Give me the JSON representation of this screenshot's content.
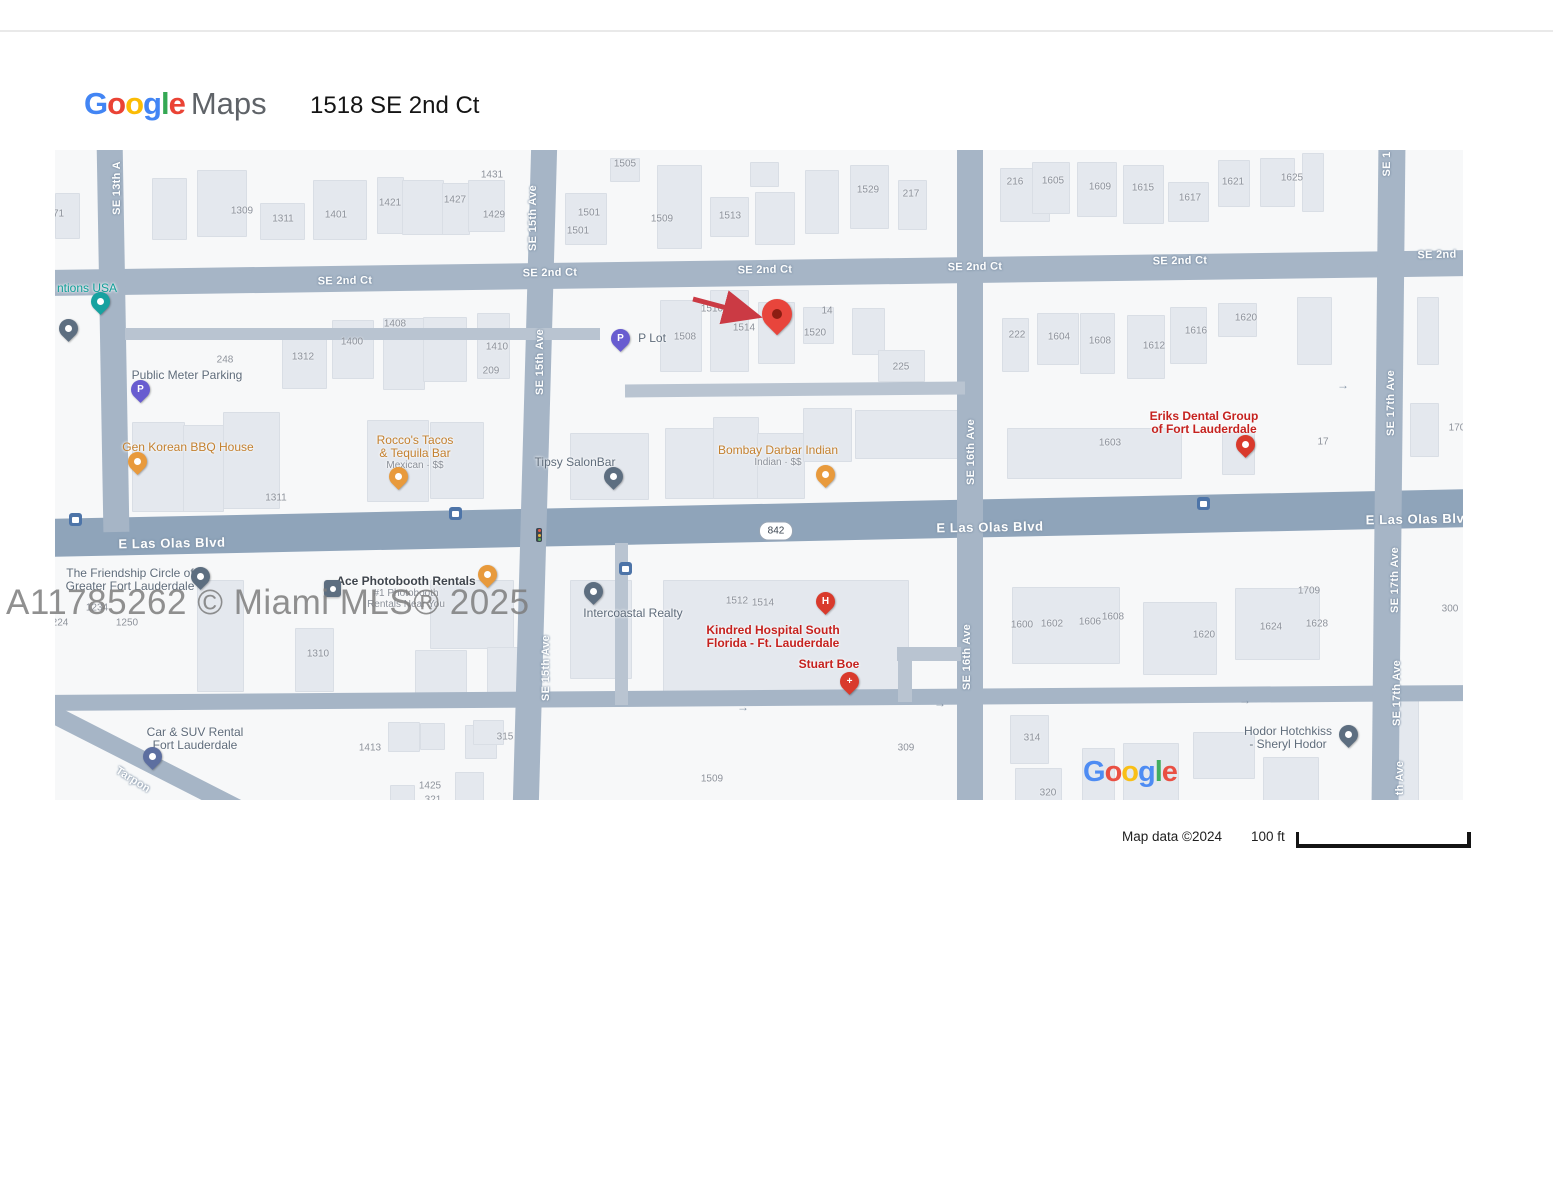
{
  "header": {
    "logo_google": "Google",
    "logo_maps": "Maps",
    "google_colors": [
      "#4285F4",
      "#EA4335",
      "#FBBC05",
      "#4285F4",
      "#34A853",
      "#EA4335"
    ],
    "title": "1518 SE 2nd Ct"
  },
  "watermark": "A11785262 © Miami MLS® 2025",
  "attribution": {
    "map_data": "Map data ©2024",
    "scale_label": "100 ft"
  },
  "map": {
    "google_logo": "Google",
    "colors": {
      "ave": "#a6b5c6",
      "major": "#8fa4ba",
      "minor": "#b9c4d1",
      "teal": "#17a2a0",
      "slate": "#5d6e80",
      "purple": "#685cd0",
      "orange": "#e89a3c",
      "red": "#d93a2c",
      "carblue": "#5d6fa0",
      "dest": "#e8453c",
      "pteal": "#0f9e98",
      "pgray": "#5f6c7b",
      "porange": "#c3802f",
      "pred": "#c5221f",
      "pdark": "#3f454d"
    },
    "roads": [
      {
        "x": -10,
        "y": 110,
        "w": 1430,
        "h": 26,
        "rot": -0.8,
        "c": "ave"
      },
      {
        "x": -10,
        "y": 354,
        "w": 1430,
        "h": 38,
        "rot": -1.2,
        "c": "major"
      },
      {
        "x": -10,
        "y": 540,
        "w": 1430,
        "h": 16,
        "rot": -0.4,
        "c": "ave"
      },
      {
        "x": 45,
        "y": -8,
        "w": 26,
        "h": 390,
        "rot": -1,
        "c": "ave"
      },
      {
        "x": 467,
        "y": -8,
        "w": 26,
        "h": 666,
        "rot": 1.6,
        "c": "ave"
      },
      {
        "x": 902,
        "y": -8,
        "w": 26,
        "h": 666,
        "rot": 0,
        "c": "ave"
      },
      {
        "x": 1320,
        "y": -8,
        "w": 27,
        "h": 666,
        "rot": 0.6,
        "c": "ave"
      },
      {
        "x": 70,
        "y": 178,
        "w": 475,
        "h": 12,
        "rot": 0,
        "c": "minor"
      },
      {
        "x": 570,
        "y": 233,
        "w": 340,
        "h": 13,
        "rot": -0.5,
        "c": "minor"
      },
      {
        "x": 560,
        "y": 393,
        "w": 13,
        "h": 162,
        "rot": 0,
        "c": "minor"
      },
      {
        "x": 842,
        "y": 497,
        "w": 64,
        "h": 14,
        "rot": 0,
        "c": "minor"
      },
      {
        "x": 843,
        "y": 497,
        "w": 14,
        "h": 55,
        "rot": 0,
        "c": "minor"
      },
      {
        "x": -45,
        "y": 597,
        "w": 250,
        "h": 18,
        "rot": 27,
        "c": "ave"
      }
    ],
    "buildings": [
      [
        0,
        43,
        23,
        44
      ],
      [
        97,
        28,
        33,
        60
      ],
      [
        142,
        20,
        48,
        65
      ],
      [
        205,
        53,
        43,
        35
      ],
      [
        258,
        30,
        52,
        58
      ],
      [
        322,
        27,
        25,
        55
      ],
      [
        347,
        30,
        40,
        53
      ],
      [
        387,
        33,
        26,
        50
      ],
      [
        413,
        30,
        35,
        50
      ],
      [
        510,
        43,
        40,
        50
      ],
      [
        555,
        8,
        28,
        22
      ],
      [
        602,
        15,
        43,
        82
      ],
      [
        655,
        47,
        37,
        38
      ],
      [
        695,
        12,
        27,
        23
      ],
      [
        700,
        42,
        38,
        51
      ],
      [
        750,
        20,
        32,
        62
      ],
      [
        795,
        15,
        37,
        62
      ],
      [
        843,
        30,
        27,
        48
      ],
      [
        945,
        18,
        48,
        52
      ],
      [
        977,
        12,
        36,
        50
      ],
      [
        1022,
        12,
        38,
        53
      ],
      [
        1068,
        15,
        39,
        57
      ],
      [
        1113,
        32,
        39,
        38
      ],
      [
        1163,
        10,
        30,
        45
      ],
      [
        1205,
        8,
        33,
        47
      ],
      [
        1247,
        3,
        20,
        57
      ],
      [
        227,
        182,
        43,
        55
      ],
      [
        277,
        170,
        40,
        57
      ],
      [
        328,
        168,
        40,
        70
      ],
      [
        368,
        167,
        42,
        63
      ],
      [
        422,
        163,
        31,
        64
      ],
      [
        605,
        150,
        40,
        70
      ],
      [
        655,
        140,
        37,
        80
      ],
      [
        703,
        152,
        35,
        60
      ],
      [
        748,
        157,
        29,
        35
      ],
      [
        797,
        158,
        31,
        45
      ],
      [
        823,
        200,
        45,
        30
      ],
      [
        947,
        168,
        25,
        52
      ],
      [
        982,
        163,
        40,
        50
      ],
      [
        1025,
        163,
        33,
        59
      ],
      [
        1072,
        165,
        36,
        62
      ],
      [
        1115,
        157,
        35,
        55
      ],
      [
        1163,
        153,
        37,
        32
      ],
      [
        1242,
        147,
        33,
        66
      ],
      [
        1362,
        147,
        20,
        66
      ],
      [
        952,
        278,
        173,
        49
      ],
      [
        1167,
        282,
        31,
        41
      ],
      [
        1355,
        253,
        27,
        52
      ],
      [
        77,
        272,
        51,
        88
      ],
      [
        128,
        275,
        39,
        85
      ],
      [
        168,
        262,
        55,
        95
      ],
      [
        312,
        270,
        60,
        80
      ],
      [
        375,
        272,
        52,
        75
      ],
      [
        515,
        283,
        77,
        65
      ],
      [
        610,
        278,
        47,
        69
      ],
      [
        658,
        267,
        44,
        80
      ],
      [
        702,
        283,
        46,
        64
      ],
      [
        748,
        258,
        47,
        52
      ],
      [
        800,
        260,
        105,
        47
      ],
      [
        142,
        430,
        45,
        110
      ],
      [
        240,
        478,
        37,
        62
      ],
      [
        375,
        430,
        82,
        67
      ],
      [
        360,
        500,
        50,
        50
      ],
      [
        432,
        497,
        41,
        50
      ],
      [
        515,
        430,
        60,
        97
      ],
      [
        608,
        430,
        244,
        117
      ],
      [
        957,
        437,
        106,
        75
      ],
      [
        1088,
        452,
        72,
        71
      ],
      [
        1180,
        438,
        83,
        70
      ],
      [
        955,
        565,
        37,
        47
      ],
      [
        960,
        618,
        45,
        32
      ],
      [
        1027,
        598,
        31,
        52
      ],
      [
        1068,
        593,
        54,
        57
      ],
      [
        1138,
        582,
        60,
        45
      ],
      [
        1208,
        607,
        54,
        43
      ],
      [
        1338,
        538,
        24,
        112
      ],
      [
        333,
        572,
        30,
        28
      ],
      [
        365,
        573,
        23,
        25
      ],
      [
        410,
        575,
        30,
        32
      ],
      [
        400,
        622,
        27,
        28
      ],
      [
        335,
        635,
        23,
        15
      ],
      [
        418,
        570,
        29,
        23
      ]
    ],
    "numbers": [
      [
        "1271",
        -2,
        64
      ],
      [
        "1309",
        187,
        61
      ],
      [
        "1311",
        228,
        69
      ],
      [
        "1401",
        281,
        65
      ],
      [
        "1421",
        335,
        53
      ],
      [
        "1427",
        400,
        50
      ],
      [
        "1429",
        439,
        65
      ],
      [
        "1431",
        437,
        25
      ],
      [
        "1505",
        570,
        14
      ],
      [
        "1501",
        534,
        63
      ],
      [
        "1501",
        523,
        81
      ],
      [
        "1509",
        607,
        69
      ],
      [
        "1513",
        675,
        66
      ],
      [
        "1529",
        813,
        40
      ],
      [
        "217",
        856,
        44
      ],
      [
        "216",
        960,
        32
      ],
      [
        "1605",
        998,
        31
      ],
      [
        "1609",
        1045,
        37
      ],
      [
        "1615",
        1088,
        38
      ],
      [
        "1617",
        1135,
        48
      ],
      [
        "1621",
        1178,
        32
      ],
      [
        "1625",
        1237,
        28
      ],
      [
        "1408",
        340,
        174
      ],
      [
        "1400",
        297,
        192
      ],
      [
        "1312",
        248,
        207
      ],
      [
        "248",
        170,
        210
      ],
      [
        "1410",
        442,
        197
      ],
      [
        "209",
        436,
        221
      ],
      [
        "1510",
        657,
        159
      ],
      [
        "1514",
        689,
        178
      ],
      [
        "1508",
        630,
        187
      ],
      [
        "14",
        772,
        161
      ],
      [
        "1520",
        760,
        183
      ],
      [
        "225",
        846,
        217
      ],
      [
        "222",
        962,
        185
      ],
      [
        "1604",
        1004,
        187
      ],
      [
        "1608",
        1045,
        191
      ],
      [
        "1612",
        1099,
        196
      ],
      [
        "1616",
        1141,
        181
      ],
      [
        "1620",
        1191,
        168
      ],
      [
        "1603",
        1055,
        293
      ],
      [
        "17",
        1268,
        292
      ],
      [
        "1311",
        221,
        348
      ],
      [
        "170",
        1402,
        278
      ],
      [
        "1234",
        42,
        458
      ],
      [
        "224",
        5,
        473
      ],
      [
        "1250",
        72,
        473
      ],
      [
        "1310",
        263,
        504
      ],
      [
        "1413",
        315,
        598
      ],
      [
        "315",
        450,
        587
      ],
      [
        "1425",
        375,
        636
      ],
      [
        "321",
        378,
        650
      ],
      [
        "1509",
        657,
        629
      ],
      [
        "309",
        851,
        598
      ],
      [
        "1512",
        682,
        451
      ],
      [
        "1514",
        708,
        453
      ],
      [
        "1600",
        967,
        475
      ],
      [
        "1602",
        997,
        474
      ],
      [
        "1606",
        1035,
        472
      ],
      [
        "1608",
        1058,
        467
      ],
      [
        "1620",
        1149,
        485
      ],
      [
        "1624",
        1216,
        477
      ],
      [
        "1628",
        1262,
        474
      ],
      [
        "1709",
        1254,
        441
      ],
      [
        "300",
        1395,
        459
      ],
      [
        "314",
        977,
        588
      ],
      [
        "320",
        993,
        643
      ]
    ],
    "street_labels": [
      [
        "SE 2nd Ct",
        290,
        131,
        -1
      ],
      [
        "SE 2nd Ct",
        495,
        123,
        -1
      ],
      [
        "SE 2nd Ct",
        710,
        120,
        -1
      ],
      [
        "SE 2nd Ct",
        920,
        117,
        -1
      ],
      [
        "SE 2nd Ct",
        1125,
        111,
        -1
      ],
      [
        "SE 2nd",
        1382,
        105,
        -1
      ],
      [
        "SE 13th A",
        62,
        38,
        -90
      ],
      [
        "SE 15th Ave",
        478,
        68,
        -90
      ],
      [
        "SE 15th Ave",
        485,
        212,
        -90
      ],
      [
        "SE 15th Ave",
        491,
        518,
        -90
      ],
      [
        "SE 16th Ave",
        916,
        302,
        -90
      ],
      [
        "SE 16th Ave",
        912,
        507,
        -90
      ],
      [
        "SE 1",
        1332,
        14,
        -90
      ],
      [
        "SE 17th Ave",
        1336,
        253,
        -90
      ],
      [
        "SE 17th Ave",
        1340,
        430,
        -90
      ],
      [
        "SE 17th Ave",
        1342,
        543,
        -90
      ],
      [
        "th Ave",
        1345,
        628,
        -90
      ],
      [
        "E Las Olas Blvd",
        117,
        393,
        -1,
        1
      ],
      [
        "E Las Olas Blvd",
        935,
        377,
        -1,
        1
      ],
      [
        "E Las Olas Blv",
        1360,
        369,
        -1,
        1
      ],
      [
        "Tarpon",
        78,
        630,
        32
      ]
    ],
    "pois": [
      {
        "lines": [
          "ntions USA"
        ],
        "c": "pteal",
        "x": 32,
        "y": 132
      },
      {
        "lines": [
          "Public Meter Parking"
        ],
        "c": "pgray",
        "x": 132,
        "y": 219
      },
      {
        "lines": [
          "Gen Korean BBQ House"
        ],
        "c": "porange",
        "x": 133,
        "y": 291
      },
      {
        "lines": [
          "Rocco's Tacos",
          "& Tequila Bar"
        ],
        "sub": [
          "Mexican · $$"
        ],
        "c": "porange",
        "x": 360,
        "y": 284
      },
      {
        "lines": [
          "P Lot"
        ],
        "c": "pgray",
        "x": 597,
        "y": 182
      },
      {
        "lines": [
          "Tipsy SalonBar"
        ],
        "c": "pgray",
        "x": 520,
        "y": 306
      },
      {
        "lines": [
          "Bombay Darbar Indian"
        ],
        "sub": [
          "Indian · $$"
        ],
        "c": "porange",
        "x": 723,
        "y": 294
      },
      {
        "lines": [
          "Eriks Dental Group",
          "of Fort Lauderdale"
        ],
        "c": "pred",
        "x": 1149,
        "y": 260,
        "bold": 1
      },
      {
        "lines": [
          "The Friendship Circle of",
          "Greater Fort Lauderdale"
        ],
        "c": "pgray",
        "x": 75,
        "y": 417
      },
      {
        "lines": [
          "Ace Photobooth Rentals"
        ],
        "sub": [
          "#1 Photobooth",
          "Rentals Near You"
        ],
        "c": "pdark",
        "x": 351,
        "y": 425,
        "bold": 1
      },
      {
        "lines": [
          "Intercoastal Realty"
        ],
        "c": "pgray",
        "x": 578,
        "y": 457
      },
      {
        "lines": [
          "Kindred Hospital South",
          "Florida - Ft. Lauderdale"
        ],
        "c": "pred",
        "x": 718,
        "y": 474,
        "bold": 1
      },
      {
        "lines": [
          "Stuart Boe"
        ],
        "c": "pred",
        "x": 774,
        "y": 508,
        "bold": 1
      },
      {
        "lines": [
          "Car & SUV Rental",
          "Fort Lauderdale"
        ],
        "c": "pgray",
        "x": 140,
        "y": 576
      },
      {
        "lines": [
          "Hodor Hotchkiss",
          "- Sheryl Hodor"
        ],
        "c": "pgray",
        "x": 1233,
        "y": 575
      }
    ],
    "pins": [
      {
        "t": "pin",
        "c": "teal",
        "x": 45,
        "y": 165,
        "n": "inventions-usa-pin"
      },
      {
        "t": "pin",
        "c": "slate",
        "x": 13,
        "y": 192,
        "n": "business-pin"
      },
      {
        "t": "pin",
        "c": "purple",
        "x": 85,
        "y": 253,
        "g": "P",
        "n": "public-meter-parking-pin"
      },
      {
        "t": "pin",
        "c": "orange",
        "x": 82,
        "y": 325,
        "n": "gen-korean-bbq-pin"
      },
      {
        "t": "pin",
        "c": "orange",
        "x": 343,
        "y": 340,
        "n": "roccos-tacos-pin"
      },
      {
        "t": "pin",
        "c": "purple",
        "x": 565,
        "y": 202,
        "g": "P",
        "n": "p-lot-pin"
      },
      {
        "t": "pin",
        "c": "slate",
        "x": 558,
        "y": 340,
        "n": "tipsy-salonbar-pin"
      },
      {
        "t": "pin",
        "c": "orange",
        "x": 770,
        "y": 338,
        "n": "bombay-darbar-pin"
      },
      {
        "t": "pin",
        "c": "red",
        "x": 1190,
        "y": 308,
        "n": "eriks-dental-pin"
      },
      {
        "t": "pin",
        "c": "slate",
        "x": 145,
        "y": 440,
        "n": "friendship-circle-pin"
      },
      {
        "t": "sq",
        "c": "slate",
        "x": 277,
        "y": 447,
        "n": "ace-photobooth-pin"
      },
      {
        "t": "pin",
        "c": "orange",
        "x": 432,
        "y": 438,
        "n": "restaurant-pin"
      },
      {
        "t": "pin",
        "c": "slate",
        "x": 538,
        "y": 455,
        "n": "intercoastal-realty-pin"
      },
      {
        "t": "pin",
        "c": "red",
        "x": 770,
        "y": 465,
        "g": "H",
        "n": "kindred-hospital-pin"
      },
      {
        "t": "pin",
        "c": "red",
        "x": 794,
        "y": 545,
        "g": "+",
        "n": "stuart-boe-pin"
      },
      {
        "t": "pin",
        "c": "carblue",
        "x": 97,
        "y": 620,
        "n": "car-suv-rental-pin"
      },
      {
        "t": "pin",
        "c": "slate",
        "x": 1293,
        "y": 598,
        "n": "hodor-hotchkiss-pin"
      },
      {
        "t": "big",
        "c": "dest",
        "x": 722,
        "y": 185,
        "n": "destination-pin"
      }
    ],
    "icons": [
      {
        "t": "bus",
        "x": 20,
        "y": 369
      },
      {
        "t": "bus",
        "x": 400,
        "y": 363
      },
      {
        "t": "bus",
        "x": 570,
        "y": 418
      },
      {
        "t": "bus",
        "x": 1148,
        "y": 353
      },
      {
        "t": "tl",
        "x": 484,
        "y": 385
      },
      {
        "t": "shield",
        "x": 721,
        "y": 381,
        "txt": "842"
      },
      {
        "t": "arr",
        "x": 1288,
        "y": 235
      },
      {
        "t": "arr",
        "x": 885,
        "y": 553
      },
      {
        "t": "arr",
        "x": 1190,
        "y": 550
      },
      {
        "t": "arr",
        "x": 688,
        "y": 557
      }
    ],
    "arrow": {
      "x1": 8,
      "y1": 9,
      "x2": 68,
      "y2": 25,
      "left": 630,
      "top": 140,
      "color": "#cb3a44"
    },
    "maplogo_pos": {
      "x": 1028,
      "y": 606
    }
  }
}
